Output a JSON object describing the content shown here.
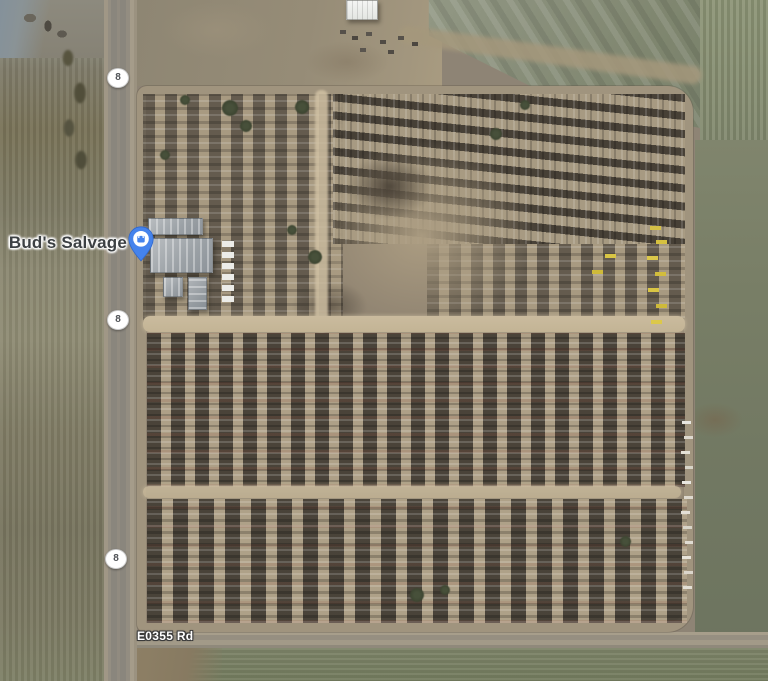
{
  "map": {
    "view": "satellite",
    "poi": {
      "label": "Bud's Salvage",
      "marker_icon": "shopping-bag-pin",
      "marker_color": "#4583EC"
    },
    "roads": {
      "bottom_road_label": "E0355 Rd",
      "route_shields": [
        {
          "label": "8"
        },
        {
          "label": "8"
        },
        {
          "label": "8"
        }
      ]
    },
    "colors": {
      "poi_label_text": "#3C4043",
      "poi_label_halo": "#FFFFFF",
      "road_label_text": "#FFFFFF",
      "road_label_outline": "#3A3A3A",
      "shield_fill": "#FFFFFF",
      "shield_text": "#4F5256",
      "yard_dirt": "#8F8371",
      "field_green": "#78806A"
    }
  }
}
